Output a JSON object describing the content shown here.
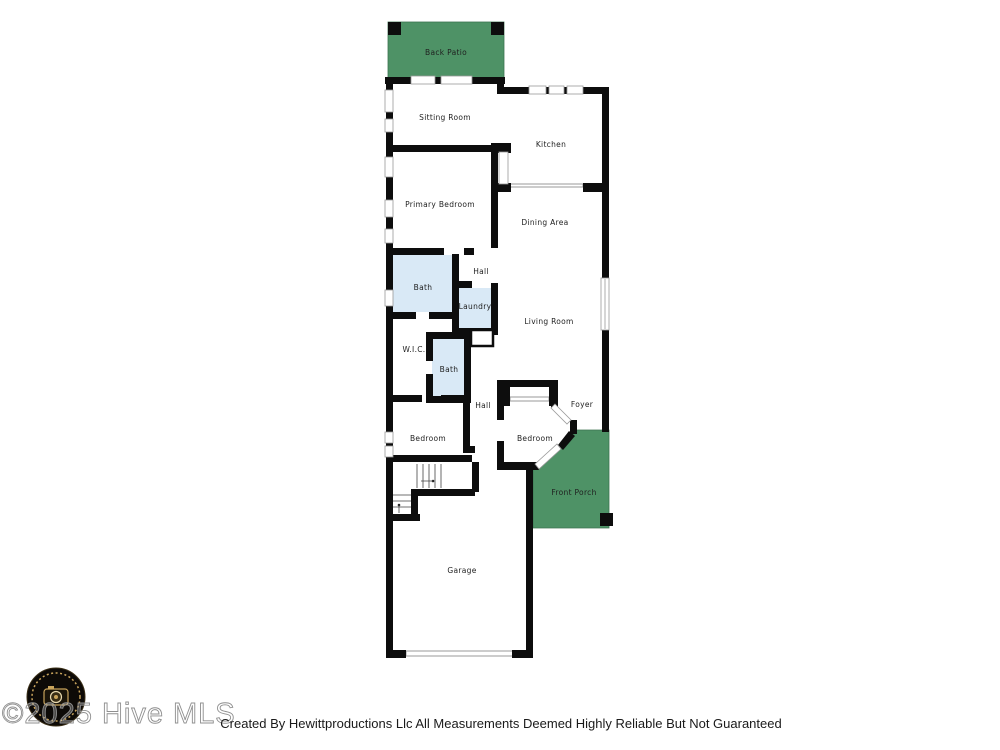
{
  "floorplan": {
    "rooms": {
      "back_patio": "Back Patio",
      "sitting_room": "Sitting Room",
      "kitchen": "Kitchen",
      "primary_bedroom": "Primary Bedroom",
      "dining_area": "Dining Area",
      "bath_primary": "Bath",
      "hall_upper": "Hall",
      "laundry": "Laundry",
      "living_room": "Living Room",
      "wic": "W.I.C.",
      "bath_hall": "Bath",
      "hall_lower": "Hall",
      "bedroom_left": "Bedroom",
      "bedroom_right": "Bedroom",
      "foyer": "Foyer",
      "front_porch": "Front Porch",
      "garage": "Garage"
    },
    "colors": {
      "outdoor_green": "#4e9266",
      "wet_room_blue": "#d9e9f6",
      "wall_black": "#0d0d0d"
    }
  },
  "watermark": {
    "text": "©2025 Hive MLS"
  },
  "footer": {
    "credit": "Created By Hewittproductions Llc All Measurements Deemed Highly Reliable But Not Guaranteed"
  }
}
